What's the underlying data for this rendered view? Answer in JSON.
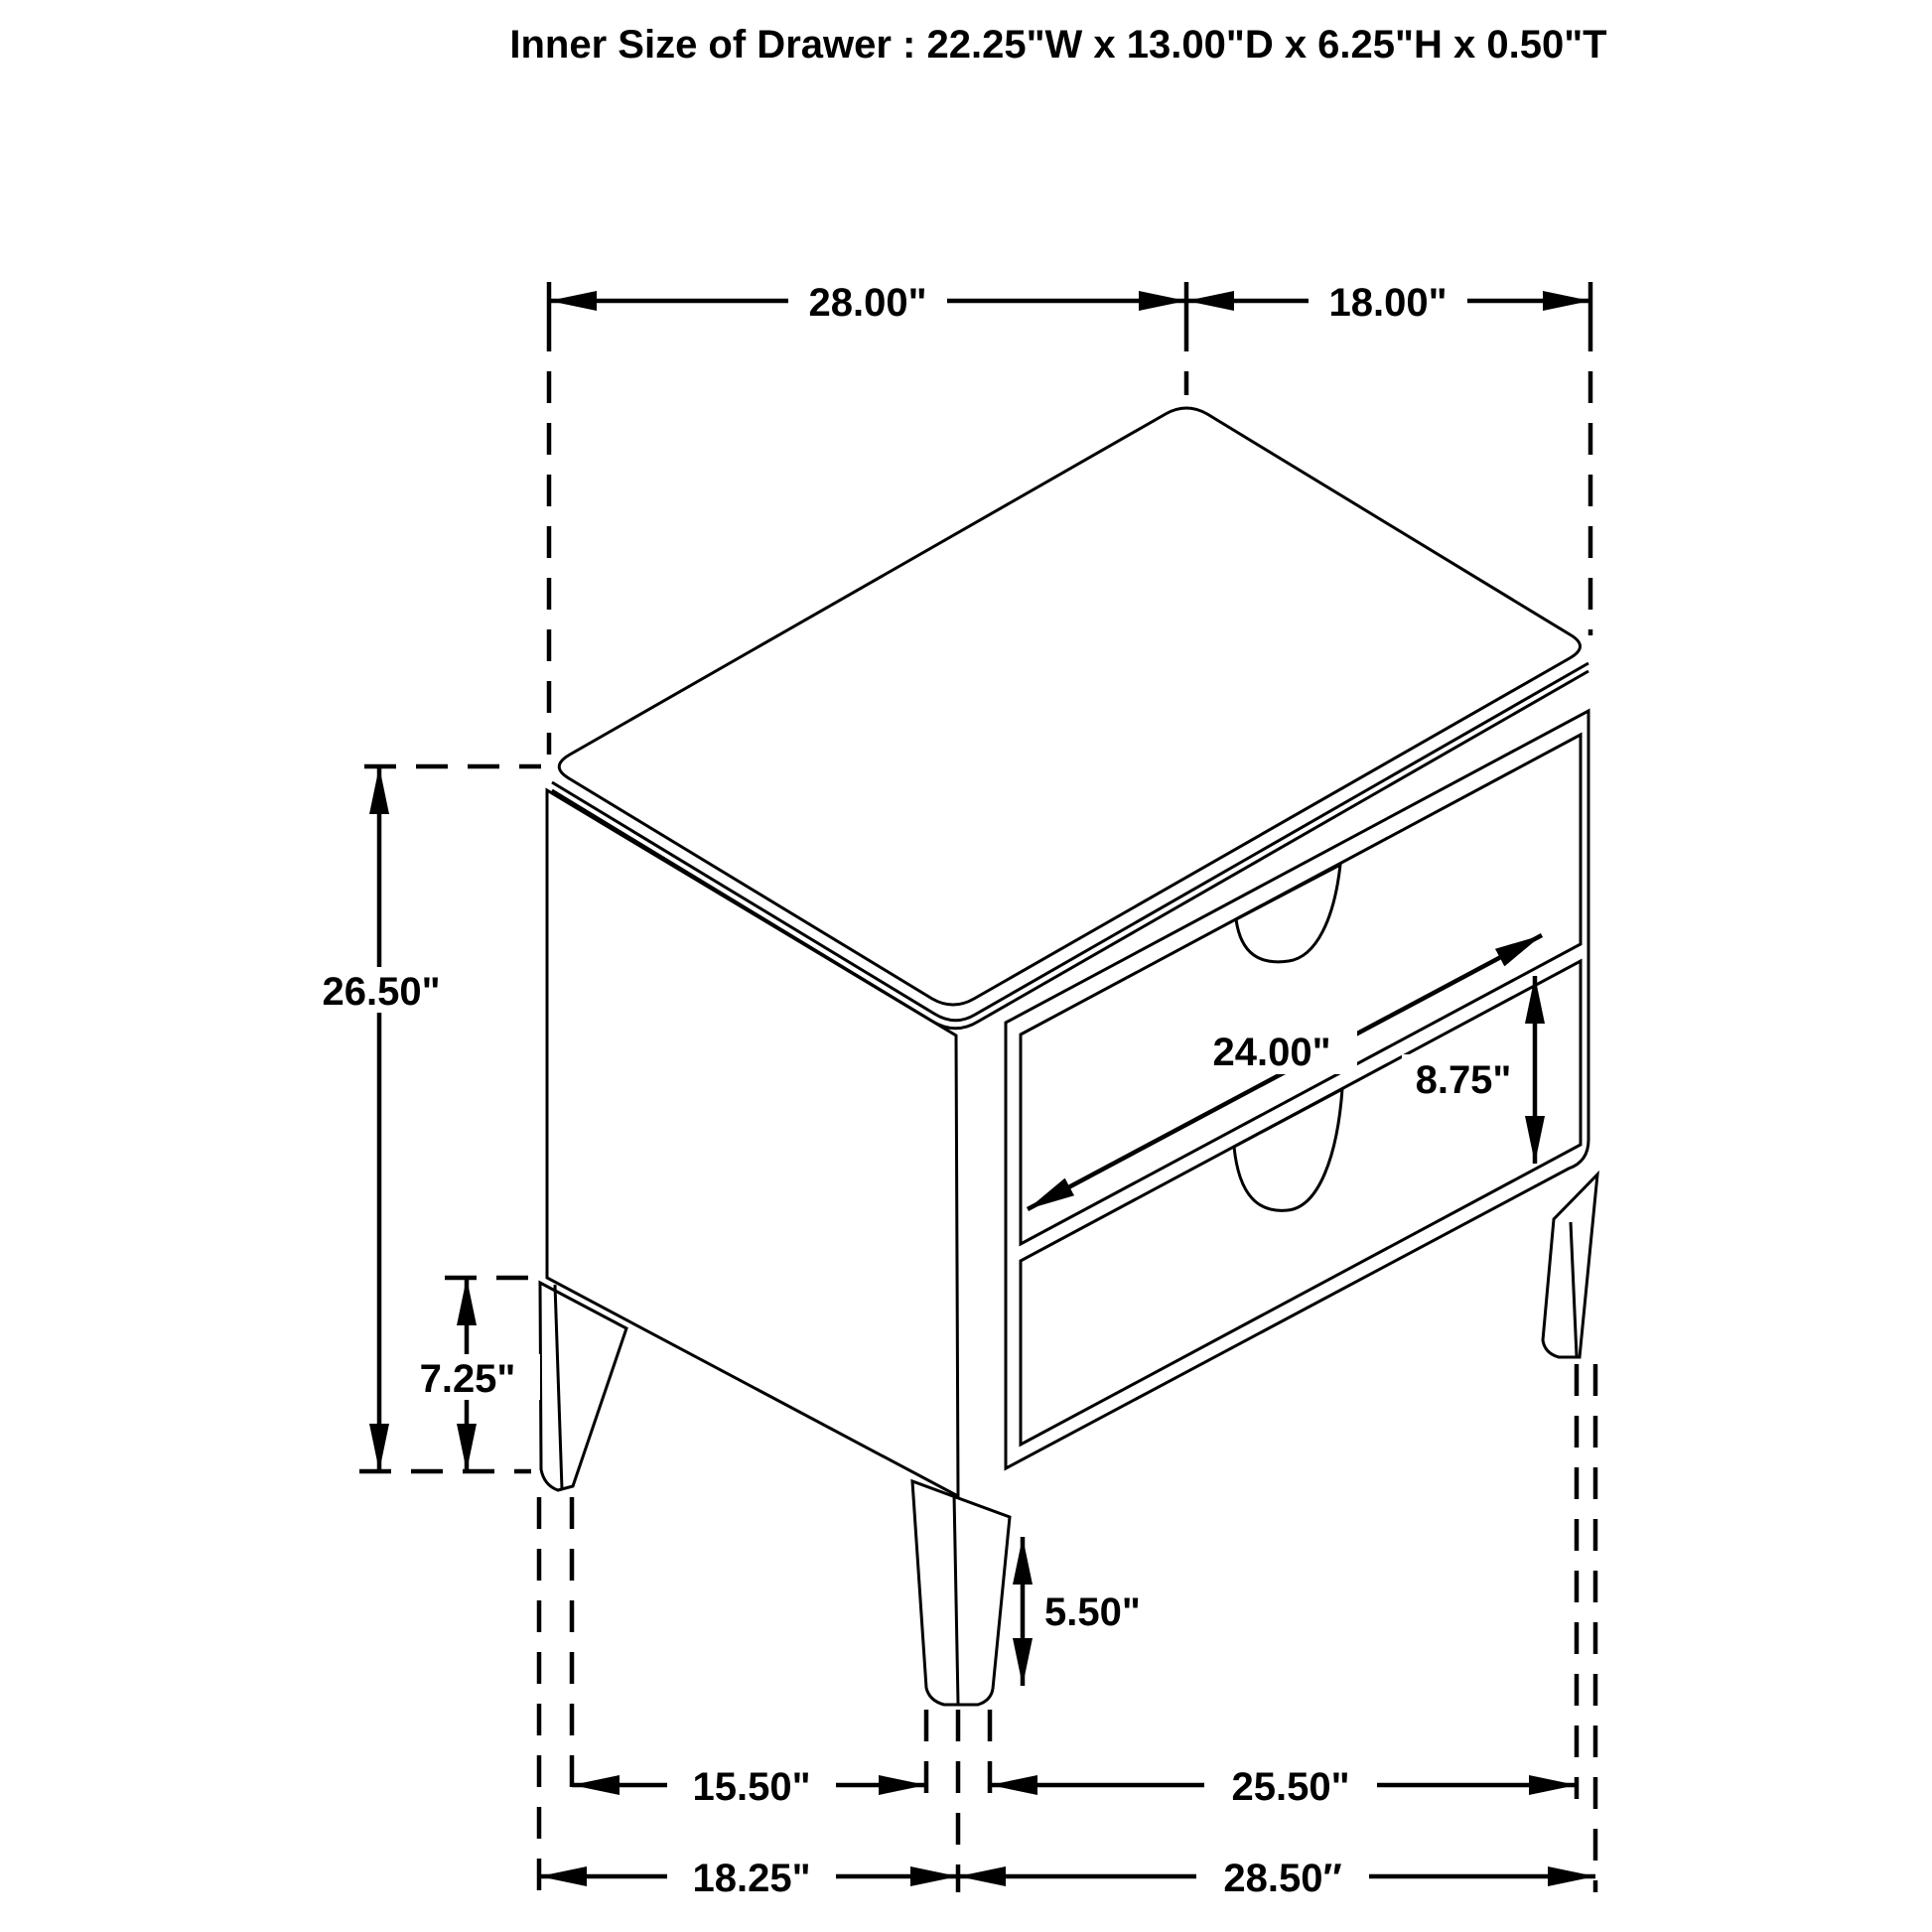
{
  "title": "Inner Size of Drawer : 22.25\"W x 13.00\"D x 6.25\"H x 0.50\"T",
  "figure": {
    "type": "furniture-dimension-diagram",
    "subject": "two-drawer nightstand line drawing"
  },
  "dimensions": {
    "top_width": "28.00\"",
    "top_depth": "18.00\"",
    "overall_height": "26.50\"",
    "leg_clearance_height": "7.25\"",
    "drawer_front_width": "24.00\"",
    "drawer_front_height": "8.75\"",
    "front_leg_height": "5.50\"",
    "floor_span_side": "15.50\"",
    "floor_span_front": "25.50\"",
    "base_overall_depth": "18.25\"",
    "base_overall_width": "28.50″"
  },
  "colors": {
    "line": "#000000",
    "background": "#ffffff"
  }
}
